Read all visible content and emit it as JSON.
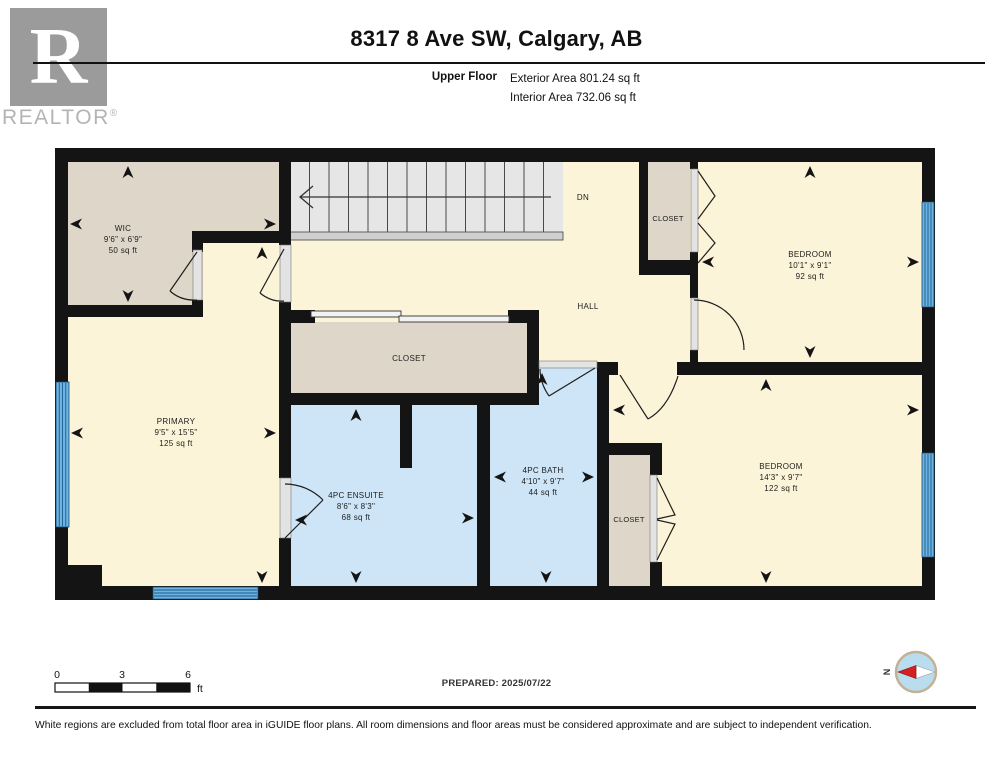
{
  "header": {
    "logo_letter": "R",
    "logo_brand": "REALTOR",
    "logo_reg": "®",
    "title": "8317 8 Ave SW, Calgary, AB",
    "floor_label": "Upper Floor",
    "exterior_area": "Exterior Area 801.24 sq ft",
    "interior_area": "Interior Area 732.06 sq ft"
  },
  "plan": {
    "rooms": {
      "wic": {
        "name": "WIC",
        "dims": "9'6\" x 6'9\"",
        "area": "50 sq ft"
      },
      "primary": {
        "name": "PRIMARY",
        "dims": "9'5\" x 15'5\"",
        "area": "125 sq ft"
      },
      "closet_mid": {
        "name": "CLOSET"
      },
      "ensuite": {
        "name": "4PC ENSUITE",
        "dims": "8'6\" x 8'3\"",
        "area": "68 sq ft"
      },
      "bath": {
        "name": "4PC BATH",
        "dims": "4'10\" x 9'7\"",
        "area": "44 sq ft"
      },
      "hall": {
        "name": "HALL"
      },
      "closet_tr": {
        "name": "CLOSET"
      },
      "bedroom_tr": {
        "name": "BEDROOM",
        "dims": "10'1\" x 9'1\"",
        "area": "92 sq ft"
      },
      "closet_br": {
        "name": "CLOSET"
      },
      "bedroom_br": {
        "name": "BEDROOM",
        "dims": "14'3\" x 9'7\"",
        "area": "122 sq ft"
      }
    },
    "stairs_label": "DN",
    "colors": {
      "cream": "#fcf4d8",
      "beige": "#ded7c9",
      "blue": "#cde5f6",
      "wall": "#141414",
      "stairs": "#e6e6e6",
      "window": "#6db4e3"
    }
  },
  "footer": {
    "scale": {
      "n0": "0",
      "n3": "3",
      "n6": "6",
      "unit": "ft"
    },
    "prepared": "PREPARED: 2025/07/22",
    "compass_n": "N",
    "disclaimer": "White regions are excluded from total floor area in iGUIDE floor plans. All room dimensions and floor areas must be considered approximate and are subject to independent verification."
  }
}
